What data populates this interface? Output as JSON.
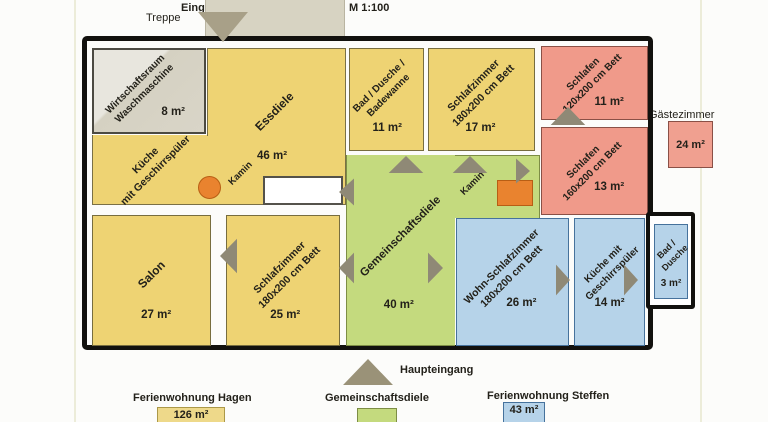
{
  "header": {
    "treppe": "Treppe",
    "eingang": "Eingang von Terrasse",
    "scale": "M 1:100"
  },
  "rooms": {
    "wirtschaftsraum": {
      "lines": [
        "Wirtschaftsraum",
        "Waschmaschine"
      ],
      "area": "8 m²"
    },
    "essdiele": {
      "lines": [
        "Essdiele"
      ],
      "area": "46 m²"
    },
    "kueche_hagen": {
      "lines": [
        "Küche",
        "mit Geschirrspüler"
      ]
    },
    "salon": {
      "lines": [
        "Salon"
      ],
      "area": "27 m²"
    },
    "schlafzimmer_hagen": {
      "lines": [
        "Schlafzimmer",
        "180x200 cm Bett"
      ],
      "area": "25 m²"
    },
    "bad_hagen": {
      "lines": [
        "Bad / Dusche /",
        "Badewanne"
      ],
      "area": "11 m²"
    },
    "schlafzimmer_mitte": {
      "lines": [
        "Schlafzimmer",
        "180x200 cm Bett"
      ],
      "area": "17 m²"
    },
    "gemeinschaftsdiele": {
      "lines": [
        "Gemeinschaftsdiele"
      ],
      "area": "40 m²"
    },
    "schlafen_klein": {
      "lines": [
        "Schlafen",
        "120x200 cm Bett"
      ],
      "area": "11 m²"
    },
    "schlafen_gross": {
      "lines": [
        "Schlafen",
        "160x200 cm Bett"
      ],
      "area": "13 m²"
    },
    "wohn_schlafzimmer": {
      "lines": [
        "Wohn-Schlafzimmer",
        "180x200 cm Bett"
      ],
      "area": "26 m²"
    },
    "kueche_steffen": {
      "lines": [
        "Küche mit",
        "Geschirrspüler"
      ],
      "area": "14 m²"
    },
    "bad_steffen": {
      "lines": [
        "Bad /",
        "Dusche"
      ],
      "area": "3 m²"
    }
  },
  "features": {
    "kamin1": "Kamin",
    "kamin2": "Kamin",
    "haupteingang": "Haupteingang",
    "gaestezimmer": {
      "label": "Gästezimmer",
      "area": "24 m²"
    }
  },
  "legend": {
    "hagen": {
      "label": "Ferienwohnung Hagen",
      "area": "126 m²"
    },
    "diele": {
      "label": "Gemeinschaftsdiele"
    },
    "steffen": {
      "label": "Ferienwohnung Steffen",
      "area": "43 m²"
    }
  },
  "colors": {
    "apartment_hagen": "#eed373",
    "gemeinschaftsdiele": "#c4da7e",
    "apartment_steffen": "#b6d3e9",
    "gaestezimmer": "#f09a8a",
    "kamin": "#e9832f",
    "wirtschaftsraum": "#d9d5c8",
    "terrasse": "#d7d3c2"
  }
}
